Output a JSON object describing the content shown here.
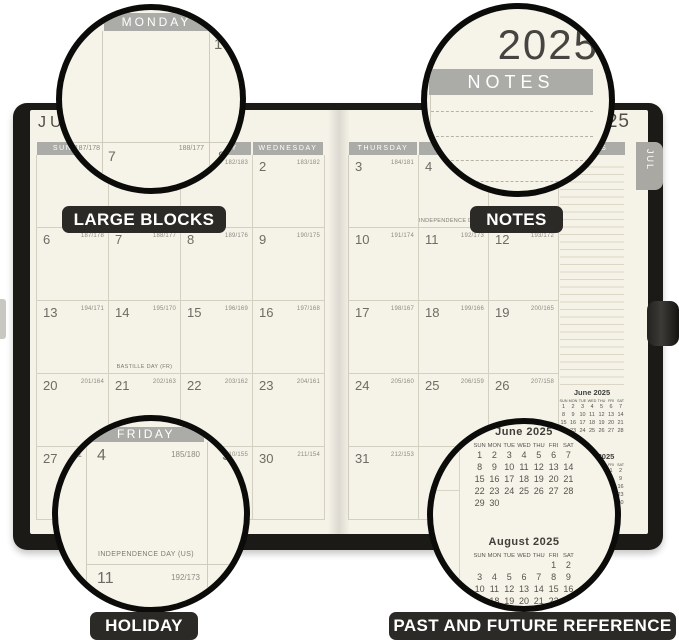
{
  "labels": {
    "large_blocks": "LARGE BLOCKS",
    "notes": "NOTES",
    "holiday": "HOLIDAY",
    "past_future": "PAST AND FUTURE REFERENCE"
  },
  "planner": {
    "left_title": "JULY",
    "right_title": "2025",
    "tab": "JUL",
    "left_weekdays": [
      "SUNDAY",
      "MONDAY",
      "TUESDAY",
      "WEDNESDAY"
    ],
    "right_weekdays": [
      "THURSDAY",
      "FRIDAY",
      "SATURDAY"
    ],
    "notes_header": "NOTES",
    "left_cells": [
      [
        {
          "d": "",
          "j": "",
          "h": ""
        },
        {
          "d": "",
          "j": "",
          "h": ""
        },
        {
          "d": "1",
          "j": "182/183",
          "h": ""
        },
        {
          "d": "2",
          "j": "183/182",
          "h": ""
        }
      ],
      [
        {
          "d": "6",
          "j": "187/178",
          "h": ""
        },
        {
          "d": "7",
          "j": "188/177",
          "h": ""
        },
        {
          "d": "8",
          "j": "189/176",
          "h": ""
        },
        {
          "d": "9",
          "j": "190/175",
          "h": ""
        }
      ],
      [
        {
          "d": "13",
          "j": "194/171",
          "h": ""
        },
        {
          "d": "14",
          "j": "195/170",
          "h": "BASTILLE DAY (FR)"
        },
        {
          "d": "15",
          "j": "196/169",
          "h": ""
        },
        {
          "d": "16",
          "j": "197/168",
          "h": ""
        }
      ],
      [
        {
          "d": "20",
          "j": "201/164",
          "h": ""
        },
        {
          "d": "21",
          "j": "202/163",
          "h": ""
        },
        {
          "d": "22",
          "j": "203/162",
          "h": ""
        },
        {
          "d": "23",
          "j": "204/161",
          "h": ""
        }
      ],
      [
        {
          "d": "27",
          "j": "208/157",
          "h": ""
        },
        {
          "d": "28",
          "j": "209/156",
          "h": ""
        },
        {
          "d": "29",
          "j": "210/155",
          "h": ""
        },
        {
          "d": "30",
          "j": "211/154",
          "h": ""
        }
      ]
    ],
    "right_cells": [
      [
        {
          "d": "3",
          "j": "184/181",
          "h": ""
        },
        {
          "d": "4",
          "j": "185/180",
          "h": "INDEPENDENCE DAY (US)"
        },
        {
          "d": "5",
          "j": "186/179",
          "h": ""
        }
      ],
      [
        {
          "d": "10",
          "j": "191/174",
          "h": ""
        },
        {
          "d": "11",
          "j": "192/173",
          "h": ""
        },
        {
          "d": "12",
          "j": "193/172",
          "h": ""
        }
      ],
      [
        {
          "d": "17",
          "j": "198/167",
          "h": ""
        },
        {
          "d": "18",
          "j": "199/166",
          "h": ""
        },
        {
          "d": "19",
          "j": "200/165",
          "h": ""
        }
      ],
      [
        {
          "d": "24",
          "j": "205/160",
          "h": ""
        },
        {
          "d": "25",
          "j": "206/159",
          "h": ""
        },
        {
          "d": "26",
          "j": "207/158",
          "h": ""
        }
      ],
      [
        {
          "d": "31",
          "j": "212/153",
          "h": ""
        },
        {
          "d": "",
          "j": "",
          "h": ""
        },
        {
          "d": "",
          "j": "",
          "h": ""
        }
      ]
    ],
    "mini_june": {
      "title": "June 2025",
      "dow": [
        "SUN",
        "MON",
        "TUE",
        "WED",
        "THU",
        "FRI",
        "SAT"
      ],
      "weeks": [
        [
          "1",
          "2",
          "3",
          "4",
          "5",
          "6",
          "7"
        ],
        [
          "8",
          "9",
          "10",
          "11",
          "12",
          "13",
          "14"
        ],
        [
          "15",
          "16",
          "17",
          "18",
          "19",
          "20",
          "21"
        ],
        [
          "22",
          "23",
          "24",
          "25",
          "26",
          "27",
          "28"
        ],
        [
          "29",
          "30",
          "",
          "",
          "",
          "",
          ""
        ]
      ]
    },
    "mini_august": {
      "title": "August 2025",
      "dow": [
        "SUN",
        "MON",
        "TUE",
        "WED",
        "THU",
        "FRI",
        "SAT"
      ],
      "weeks": [
        [
          "",
          "",
          "",
          "",
          "",
          "1",
          "2"
        ],
        [
          "3",
          "4",
          "5",
          "6",
          "7",
          "8",
          "9"
        ],
        [
          "10",
          "11",
          "12",
          "13",
          "14",
          "15",
          "16"
        ],
        [
          "17",
          "18",
          "19",
          "20",
          "21",
          "22",
          "23"
        ],
        [
          "24",
          "25",
          "26",
          "27",
          "28",
          "29",
          "30"
        ],
        [
          "31",
          "",
          "",
          "",
          "",
          "",
          ""
        ]
      ]
    }
  },
  "magnifiers": {
    "large_blocks": {
      "weekday": "MONDAY",
      "day_one": "1",
      "julian_left": "187/178",
      "day_seven": "7",
      "julian_mid": "188/177",
      "day_eight": "8"
    },
    "notes": {
      "year": "2025",
      "header": "NOTES"
    },
    "holiday": {
      "weekday": "FRIDAY",
      "day": "4",
      "julian": "185/180",
      "next_day": "5",
      "left_fragment": "181",
      "holiday_text": "INDEPENDENCE DAY (US)",
      "below_day": "11",
      "below_julian": "192/173",
      "below_next_day": "12"
    }
  }
}
